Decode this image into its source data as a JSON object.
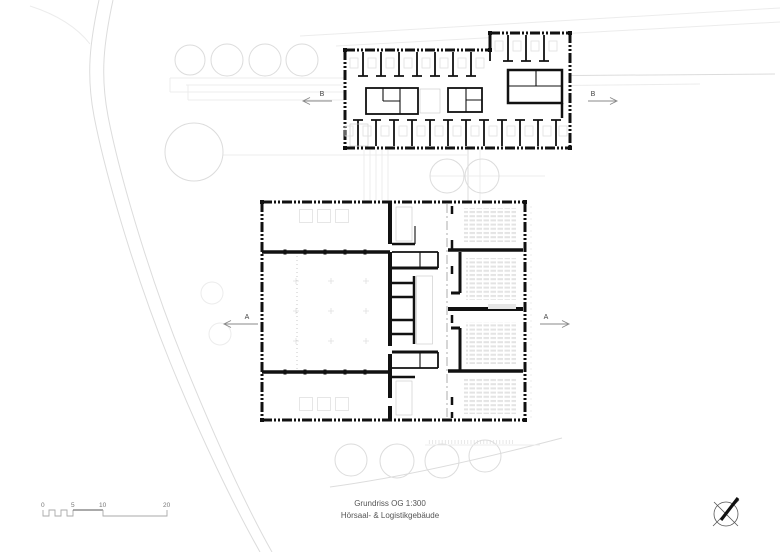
{
  "plan": {
    "title": {
      "line1": "Grundriss OG 1:300",
      "line2": "Hörsaal- & Logistikgebäude"
    },
    "section_markers": {
      "a": "A",
      "b": "B"
    },
    "scale_bar": {
      "labels": [
        "0",
        "5",
        "10",
        "20"
      ]
    },
    "icons": {
      "north_arrow": "compass-circle-with-cross-and-needle"
    },
    "colors": {
      "wall": "#111111",
      "context": "#dcdcdc",
      "context_light": "#ececec",
      "stair_hatch": "#cfcfcf",
      "seating": "#e3e3e3",
      "marker": "#888888",
      "text": "#555555"
    }
  }
}
